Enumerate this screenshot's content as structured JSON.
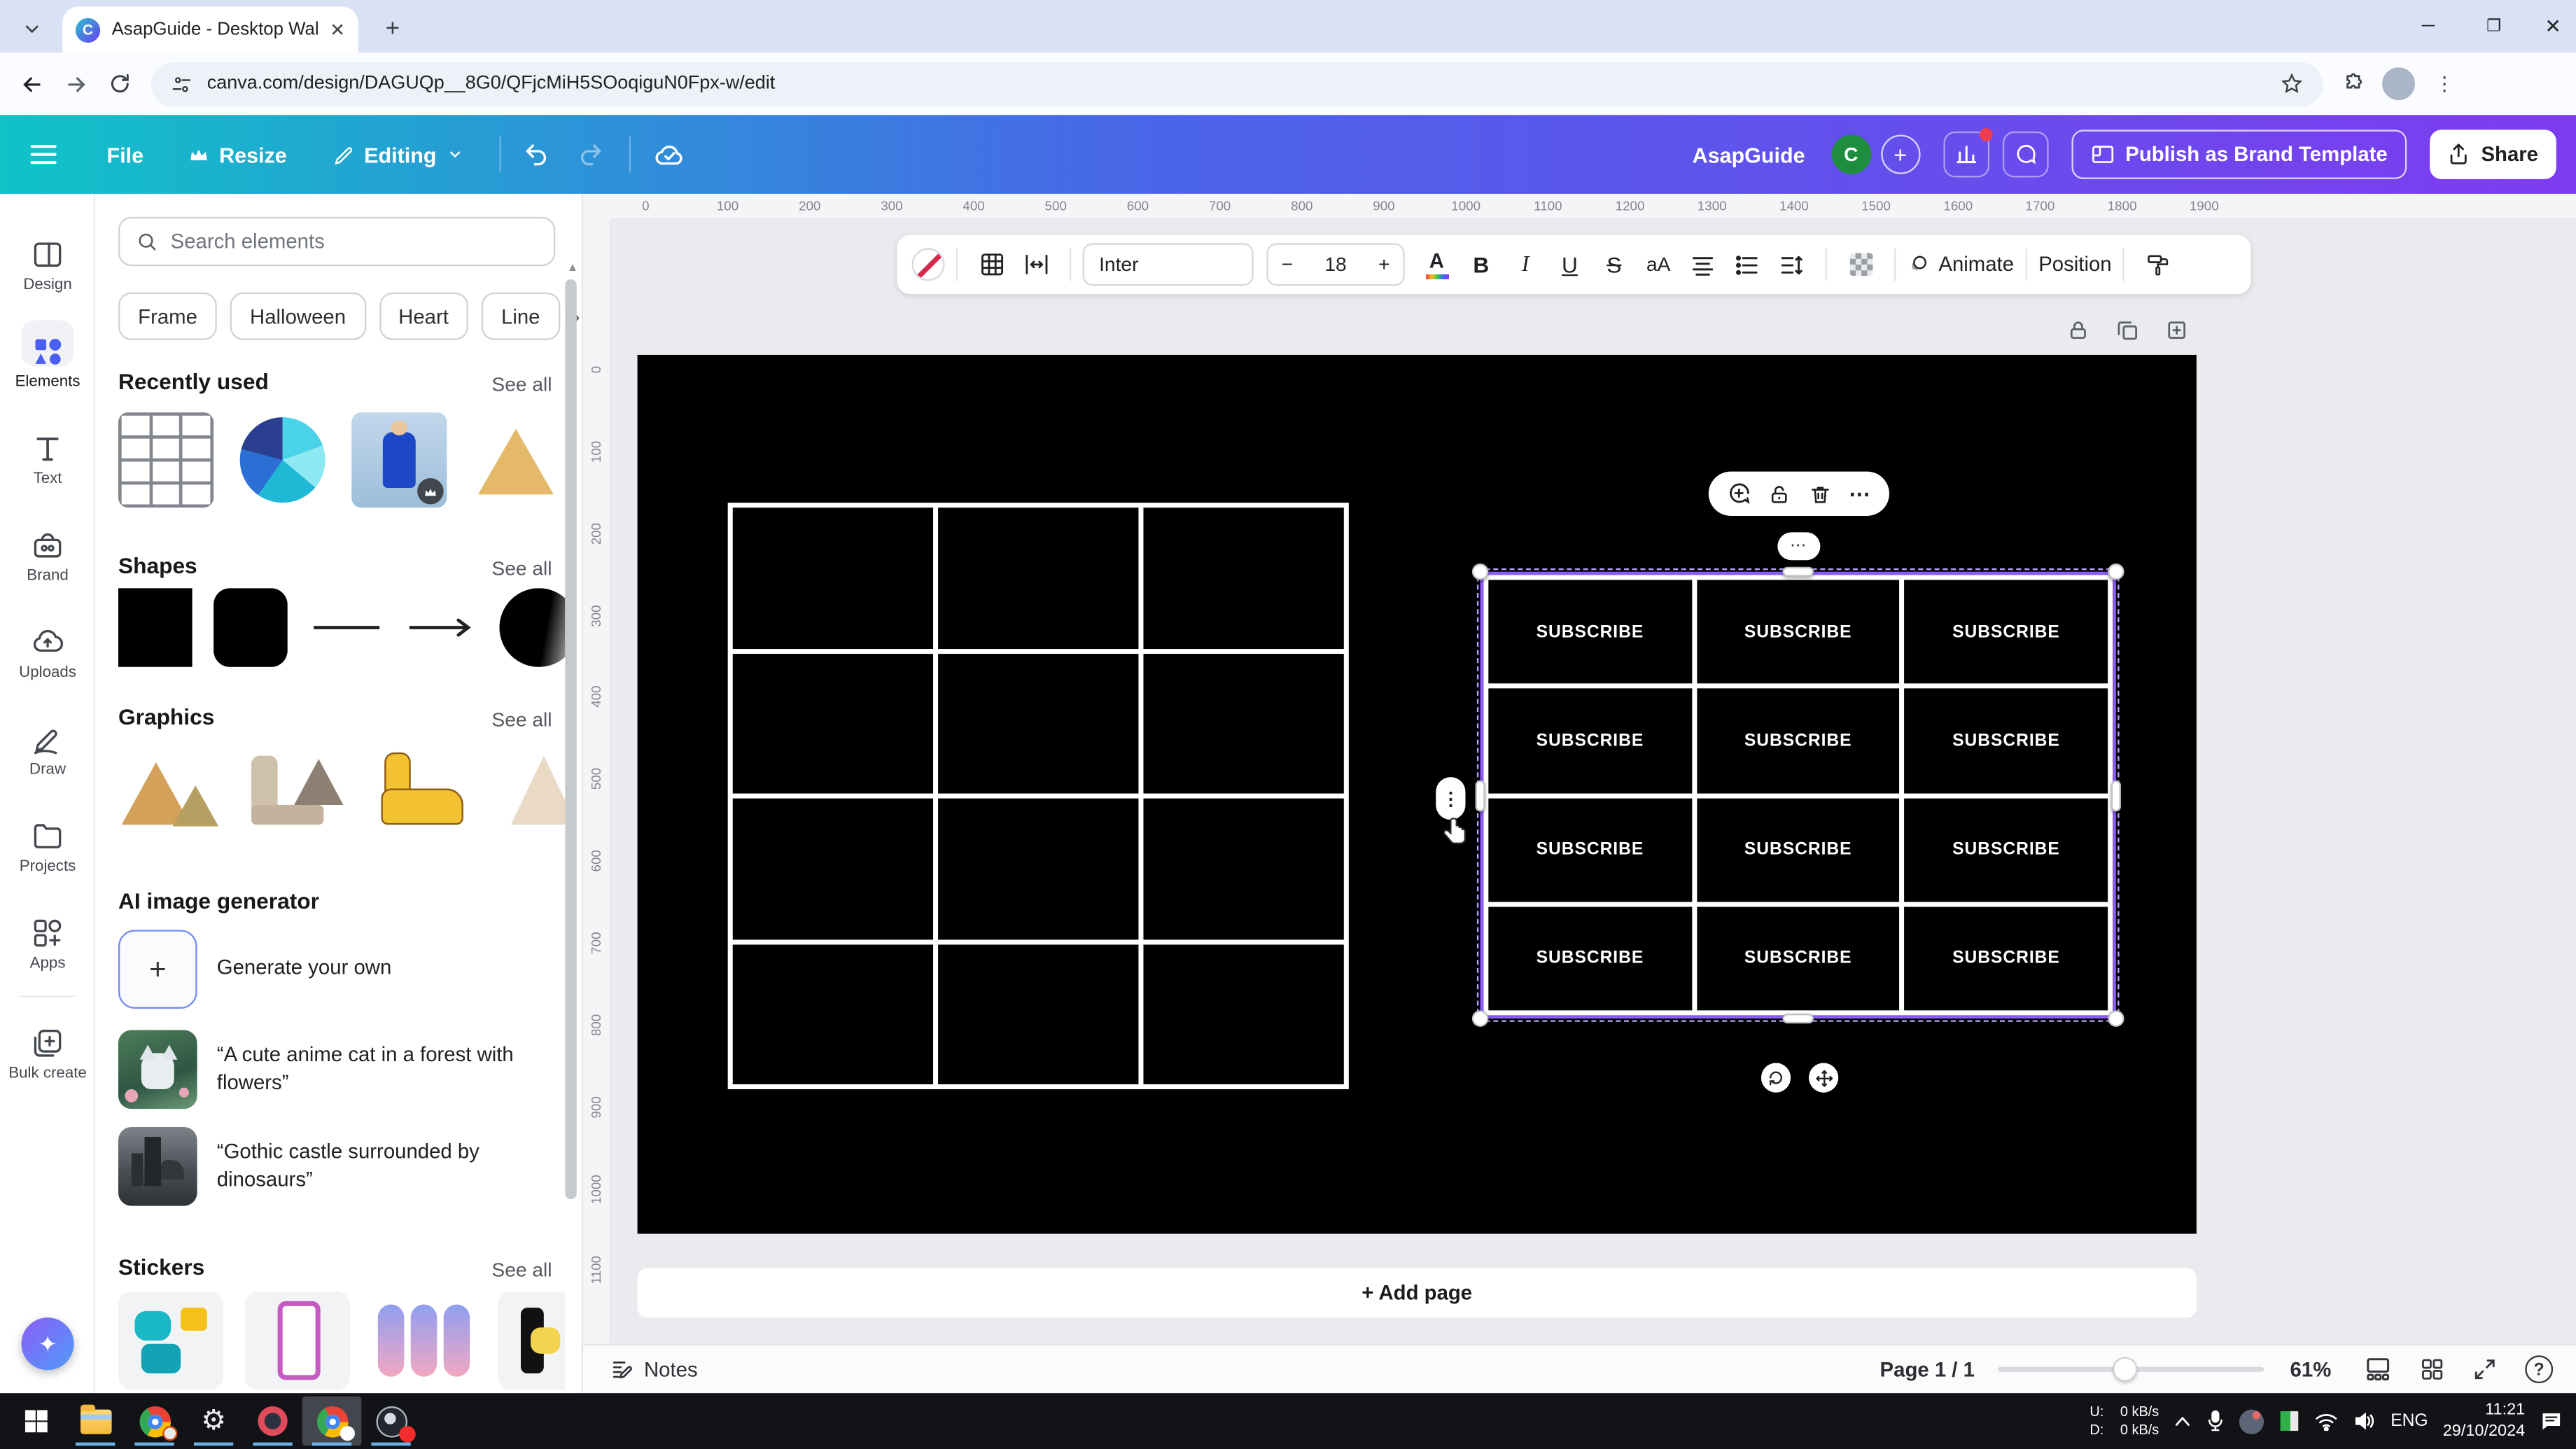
{
  "colors": {
    "accent_purple": "#8b3dff",
    "selection": "#8b5cf6",
    "toolbar_gradient_start": "#0fc3c7",
    "toolbar_gradient_mid": "#4a64e8",
    "toolbar_gradient_end": "#7e3bf0",
    "taskbar_underline": "#6cb2e8",
    "avatar_green": "#1e8e3e",
    "notification_red": "#f03d4e"
  },
  "browser": {
    "tab_title": "AsapGuide - Desktop Wallpaper",
    "url": "canva.com/design/DAGUQp__8G0/QFjcMiH5SOoqiguN0Fpx-w/edit"
  },
  "top_toolbar": {
    "file": "File",
    "resize": "Resize",
    "editing": "Editing",
    "account_name": "AsapGuide",
    "avatar_initial": "C",
    "publish": "Publish as Brand Template",
    "share": "Share"
  },
  "sidebar": {
    "items": [
      {
        "label": "Design"
      },
      {
        "label": "Elements"
      },
      {
        "label": "Text"
      },
      {
        "label": "Brand"
      },
      {
        "label": "Uploads"
      },
      {
        "label": "Draw"
      },
      {
        "label": "Projects"
      },
      {
        "label": "Apps"
      },
      {
        "label": "Bulk create"
      }
    ]
  },
  "panel": {
    "search_placeholder": "Search elements",
    "chips": [
      "Frame",
      "Halloween",
      "Heart",
      "Line"
    ],
    "see_all": "See all",
    "recently_used": "Recently used",
    "shapes": "Shapes",
    "graphics": "Graphics",
    "ai_generator": "AI image generator",
    "generate_your_own": "Generate your own",
    "prompt_cat": "“A cute anime cat in a forest with flowers”",
    "prompt_castle": "“Gothic castle surrounded by dinosaurs”",
    "stickers": "Stickers"
  },
  "context_toolbar": {
    "font": "Inter",
    "font_size": "18",
    "bold": "B",
    "italic": "I",
    "underline": "U",
    "strike": "S",
    "case": "aA",
    "animate": "Animate",
    "position": "Position"
  },
  "canvas": {
    "subscribe_label": "SUBSCRIBE",
    "table_rows": 4,
    "table_cols": 3,
    "empty_rows": 4,
    "empty_cols": 3,
    "add_page": "+ Add page",
    "ruler_h": [
      0,
      100,
      200,
      300,
      400,
      500,
      600,
      700,
      800,
      900,
      1000,
      1100,
      1200,
      1300,
      1400,
      1500,
      1600,
      1700,
      1800,
      1900
    ],
    "ruler_v": [
      0,
      100,
      200,
      300,
      400,
      500,
      600,
      700,
      800,
      900,
      1000,
      1100
    ]
  },
  "statusbar": {
    "notes": "Notes",
    "page_indicator": "Page 1 / 1",
    "zoom_percent": "61%"
  },
  "taskbar": {
    "net_up_label": "U:",
    "net_down_label": "D:",
    "net_up_value": "0 kB/s",
    "net_down_value": "0 kB/s",
    "language": "ENG",
    "time": "11:21",
    "date": "29/10/2024"
  }
}
